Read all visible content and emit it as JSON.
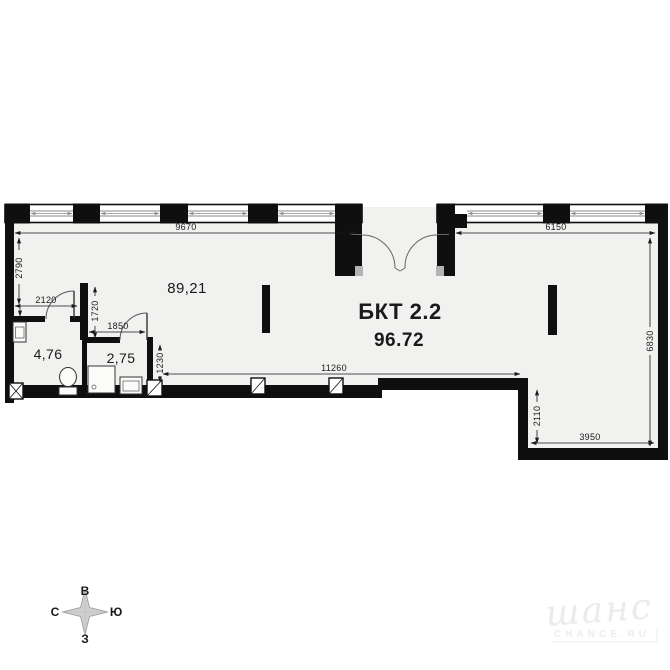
{
  "unit": {
    "name": "БКТ 2.2",
    "total_area": "96.72"
  },
  "rooms": {
    "main_area": "89,21",
    "bathroom_area": "4,76",
    "wc_area": "2,75"
  },
  "dims": {
    "top_left_width": "9670",
    "top_right_width": "6150",
    "left_height": "2790",
    "bath_width": "2120",
    "spur_height": "1720",
    "wc_width": "1850",
    "wc_wall_height": "1230",
    "bottom_main_width": "11260",
    "step_height": "2110",
    "bottom_right_width": "3950",
    "right_height": "6830"
  },
  "compass": {
    "top": "В",
    "right": "Ю",
    "left": "С",
    "bottom": "З"
  },
  "watermark": {
    "logo": "шанс",
    "caption": "CHANCE.RU"
  },
  "colors": {
    "wall": "#0f0f0f",
    "floor": "#f1f1f0",
    "dimension": "#1a1a1a",
    "glass": "#8a8a8a",
    "watermark": "#ebebeb"
  }
}
